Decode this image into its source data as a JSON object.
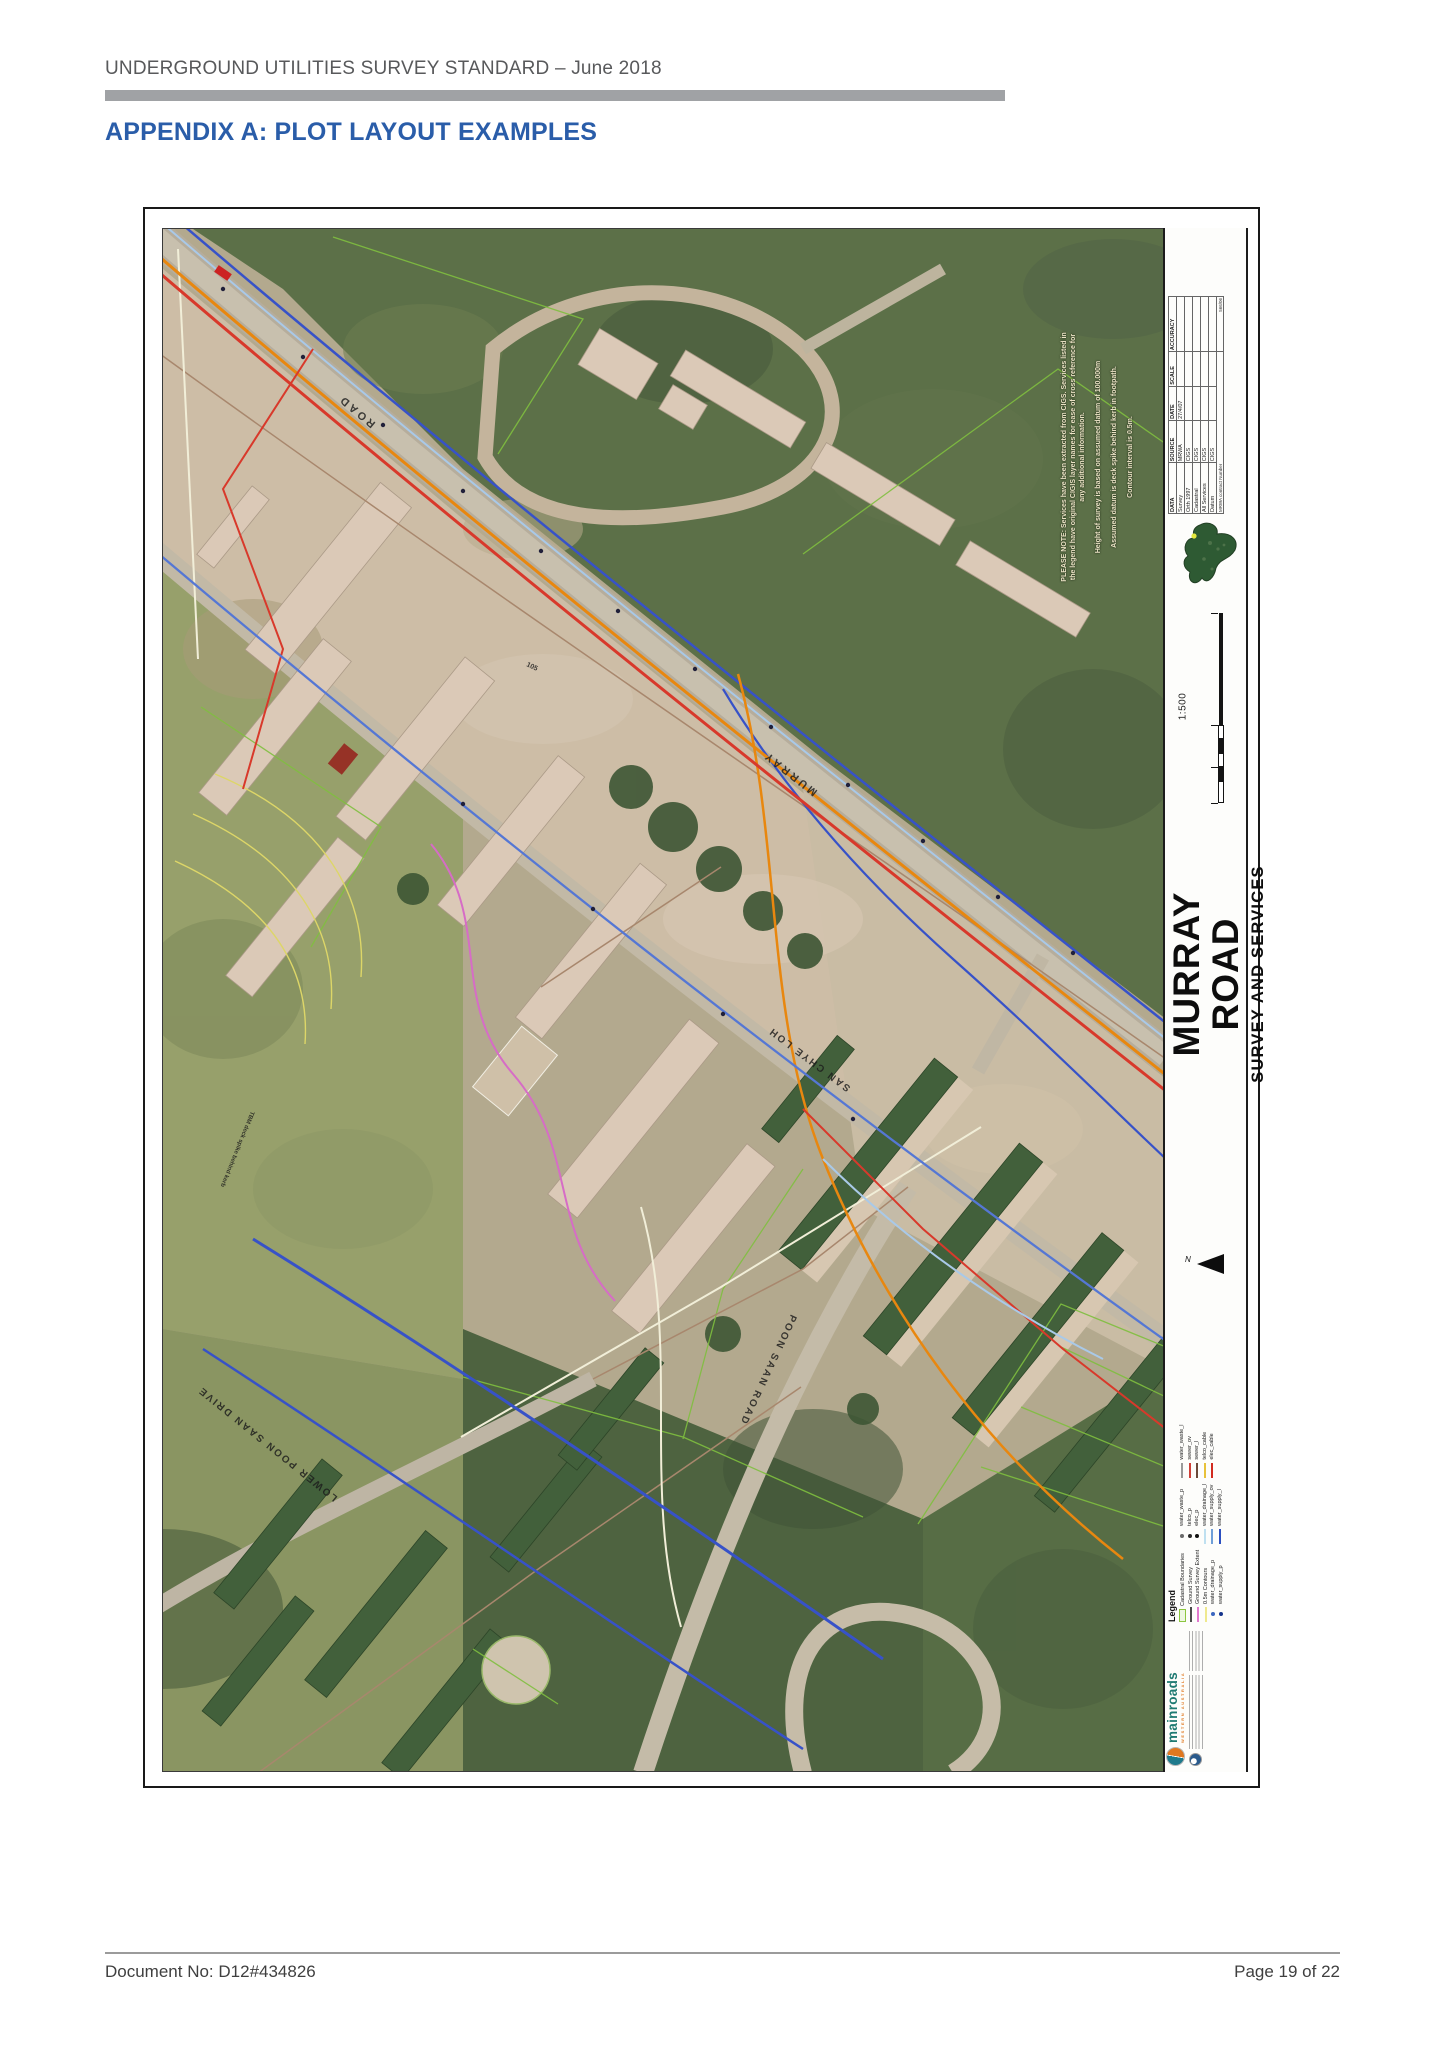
{
  "page": {
    "header": "UNDERGROUND UTILITIES SURVEY STANDARD – June 2018",
    "title": "APPENDIX A: PLOT LAYOUT EXAMPLES",
    "footer_left": "Document No: D12#434826",
    "footer_right": "Page 19 of 22"
  },
  "colors": {
    "accent_blue": "#2a5da9",
    "header_gray": "#58595b",
    "rule_gray": "#a0a2a5"
  },
  "map_sheet": {
    "title_block": {
      "road_name": "MURRAY ROAD",
      "subtitle": "SURVEY AND SERVICES",
      "scale_label": "1:500",
      "north_label": "N"
    },
    "notes": [
      "PLEASE NOTE: Services have been extracted from CIGS. Services listed in the legend have original CIGIS layer names for ease of cross reference for any additional information.",
      "Height of survey is based on assumed datum of 100.000m",
      "Assumed datum is deck spike behind kerb in footpath.",
      "Contour interval is 0.5m."
    ],
    "info_table": {
      "headers": [
        "DATA",
        "SOURCE",
        "DATE",
        "SCALE",
        "ACCURACY"
      ],
      "rows": [
        [
          "Survey",
          "MRWA",
          "27/4/07",
          "",
          ""
        ],
        [
          "Orth 1997",
          "CIGS",
          "",
          "",
          ""
        ],
        [
          "Cadastral",
          "CIGS",
          "",
          "",
          ""
        ],
        [
          "All Services",
          "CIGS",
          "",
          "",
          ""
        ],
        [
          "Datum",
          "CIGS",
          "",
          "",
          ""
        ]
      ],
      "footnote_label": "MRWA contract Number",
      "footnote_value": "566/06"
    },
    "legend": {
      "title": "Legend",
      "columns": [
        [
          {
            "label": "Cadastral Boundaries",
            "type": "box",
            "color": "#eef7e2",
            "border": "#8cc63f"
          },
          {
            "label": "Ground Survey",
            "type": "line",
            "color": "#4a4a4a"
          },
          {
            "label": "Ground Survey Extent",
            "type": "line",
            "color": "#e279cf"
          },
          {
            "label": "0.5m Contours",
            "type": "line",
            "color": "#efe98e"
          },
          {
            "label": "water_drainage_p",
            "type": "dot",
            "color": "#3b66c0"
          },
          {
            "label": "water_supply_p",
            "type": "dot",
            "color": "#16348c"
          }
        ],
        [
          {
            "label": "water_waste_p",
            "type": "dot",
            "color": "#6a6a6a"
          },
          {
            "label": "telco_p",
            "type": "dot",
            "color": "#2b2b2b"
          },
          {
            "label": "elec_p",
            "type": "dot",
            "color": "#111111"
          },
          {
            "label": "water_drainage_l",
            "type": "line",
            "color": "#bfe0f0"
          },
          {
            "label": "water_supply_ov",
            "type": "line",
            "color": "#6f9fd8"
          },
          {
            "label": "water_supply_l",
            "type": "line",
            "color": "#2b4fc0"
          }
        ],
        [
          {
            "label": "water_waste_l",
            "type": "line",
            "color": "#9a9a9a"
          },
          {
            "label": "sewer_ov",
            "type": "line",
            "color": "#d04038"
          },
          {
            "label": "sewer_l",
            "type": "line",
            "color": "#6b4a3a"
          },
          {
            "label": "telco_cable",
            "type": "line",
            "color": "#e8c23a"
          },
          {
            "label": "elec_cable",
            "type": "line",
            "color": "#d22b1f"
          }
        ]
      ]
    },
    "logos": {
      "mainroads_label": "mainroads",
      "mainroads_sub": "WESTERN AUSTRALIA"
    },
    "street_labels": [
      {
        "text": "ROAD",
        "x": 213,
        "y": 194,
        "rot": 220,
        "size": 11,
        "ls": 3
      },
      {
        "text": "MURRAY",
        "x": 655,
        "y": 562,
        "rot": 218,
        "size": 11,
        "ls": 3
      },
      {
        "text": "SAN   CHYE   LOH",
        "x": 688,
        "y": 858,
        "rot": 217,
        "size": 10,
        "ls": 2
      },
      {
        "text": "POON   SAAN   ROAD",
        "x": 628,
        "y": 1085,
        "rot": 115,
        "size": 10,
        "ls": 2
      },
      {
        "text": "LOWER   POON   SAAN   DRIVE",
        "x": 175,
        "y": 1268,
        "rot": 219,
        "size": 10,
        "ls": 2
      },
      {
        "text": "TBM deck spike behind kerb",
        "x": 88,
        "y": 882,
        "rot": 112,
        "size": 6,
        "ls": 0
      },
      {
        "text": "105",
        "x": 363,
        "y": 437,
        "rot": 25,
        "size": 7,
        "ls": 0
      }
    ]
  }
}
